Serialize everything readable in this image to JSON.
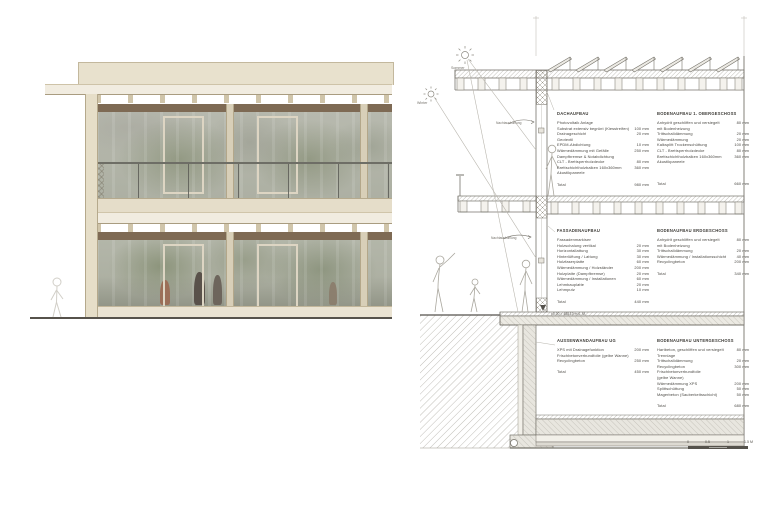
{
  "colors": {
    "cream": "#e8e1cd",
    "wood_frame": "#d8cfb8",
    "lintel_band": "#7e6a54",
    "glass": "#b4b6ac",
    "linework": "#76736b"
  },
  "icons": {
    "summer": "sun-summer-icon",
    "winter": "sun-winter-icon"
  },
  "section": {
    "labels": {
      "sommer": "Sommer",
      "winter": "Winter",
      "nacht_og": "Nachtauskühlung",
      "nacht_eg": "Nachtauskühlung",
      "level_eg": "±0.00 = 488.10 m ü. M."
    },
    "scalebar": {
      "ticks": [
        "0",
        "0.5",
        "1",
        "1.5 M"
      ]
    },
    "spec_blocks": [
      {
        "title": "DACHAUFBAU",
        "rows": [
          [
            "Photovoltaik Anlage",
            ""
          ],
          [
            "Substrat extensiv begrünt (Kiesstreifen)",
            "100 mm"
          ],
          [
            "Drainageschicht",
            "20 mm"
          ],
          [
            "Geotextil",
            ""
          ],
          [
            "EPDM-Abdichtung",
            "10 mm"
          ],
          [
            "Wärmedämmung mit Gefälle",
            "250 mm"
          ],
          [
            "Dampfbremse & Notabdichtung",
            ""
          ],
          [
            "CLT - Brettsperrholzdecke",
            "80 mm"
          ],
          [
            "Brettschichtholzbalken 160x360mm",
            "360 mm"
          ],
          [
            "Akustikpaneele",
            ""
          ]
        ],
        "total_label": "Total",
        "total_value": "980 mm"
      },
      {
        "title": "BODENAUFBAU 1. OBERGESCHOSS",
        "rows": [
          [
            "Anhydrit geschliffen und versiegelt",
            "80 mm"
          ],
          [
            "mit Bodenheizung",
            ""
          ],
          [
            "Trittschalldämmung",
            "20 mm"
          ],
          [
            "Wärmedämmung",
            "20 mm"
          ],
          [
            "Kalksplitt Trockenschüttung",
            "100 mm"
          ],
          [
            "CLT - Brettsperrholzdecke",
            "80 mm"
          ],
          [
            "Brettschichtholzbalken 160x360mm",
            "360 mm"
          ],
          [
            "Akustikpaneele",
            ""
          ]
        ],
        "total_label": "Total",
        "total_value": "660 mm"
      },
      {
        "title": "FASSADENAUFBAU",
        "rows": [
          [
            "Fassadenmarkisen",
            ""
          ],
          [
            "Holzschalung vertikal",
            "20 mm"
          ],
          [
            "Horizontallattung",
            "30 mm"
          ],
          [
            "Hinterlüftung / Lattung",
            "30 mm"
          ],
          [
            "Holzfaserplatte",
            "60 mm"
          ],
          [
            "Wärmedämmung / Holzständer",
            "200 mm"
          ],
          [
            "Holzplatte (Dampfbremse)",
            "20 mm"
          ],
          [
            "Wärmedämmung / Installationen",
            "60 mm"
          ],
          [
            "Lehmbauplatte",
            "20 mm"
          ],
          [
            "Lehmputz",
            "10 mm"
          ]
        ],
        "total_label": "Total",
        "total_value": "440 mm"
      },
      {
        "title": "BODENAUFBAU ERDGESCHOSS",
        "rows": [
          [
            "Anhydrit geschliffen und versiegelt",
            "80 mm"
          ],
          [
            "mit Bodenheizung",
            ""
          ],
          [
            "Trittschalldämmung",
            "20 mm"
          ],
          [
            "Wärmedämmung / Installationsschicht",
            "40 mm"
          ],
          [
            "Recyclingbeton",
            "200 mm"
          ]
        ],
        "total_label": "Total",
        "total_value": "340 mm"
      },
      {
        "title": "AUSSENWANDAUFBAU UG",
        "rows": [
          [
            "XPS mit Drainagefunktion",
            "200 mm"
          ],
          [
            "Frischbetonverbundfolie (gelbe Wanne)",
            ""
          ],
          [
            "Recyclingbeton",
            "250 mm"
          ]
        ],
        "total_label": "Total",
        "total_value": "450 mm"
      },
      {
        "title": "BODENAUFBAU UNTERGESCHOSS",
        "rows": [
          [
            "Hartbeton, geschliffen und versiegelt",
            "80 mm"
          ],
          [
            "Trennlage",
            ""
          ],
          [
            "Trittschalldämmung",
            "20 mm"
          ],
          [
            "Recyclingbeton",
            "300 mm"
          ],
          [
            "Frischbetonverbundfolie",
            ""
          ],
          [
            "(gelbe Wanne)",
            ""
          ],
          [
            "Wärmedämmung XPS",
            "200 mm"
          ],
          [
            "Splittschüttung",
            "50 mm"
          ],
          [
            "Magerbeton (Sauberkeitsschicht)",
            "50 mm"
          ]
        ],
        "total_label": "Total",
        "total_value": "680 mm"
      }
    ]
  }
}
